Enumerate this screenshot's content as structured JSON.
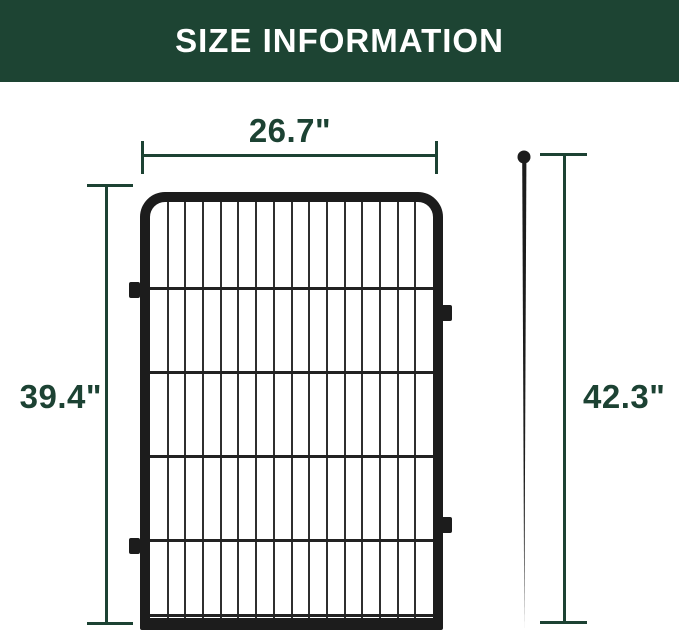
{
  "header": {
    "title": "SIZE INFORMATION"
  },
  "colors": {
    "background": "#ffffff",
    "header_bg": "#1d4433",
    "header_text": "#ffffff",
    "dimension_green": "#1c4233",
    "fence_black": "#1c1c1c",
    "wire_gray": "#2f2f2f"
  },
  "dimensions": {
    "panel_width": {
      "label": "26.7\""
    },
    "panel_height": {
      "label": "39.4\""
    },
    "stake_height": {
      "label": "42.3\""
    }
  },
  "fence": {
    "vertical_wire_count": 15,
    "horizontal_wire_offsets_px": [
      85,
      169,
      253,
      337,
      412
    ],
    "tabs": [
      {
        "side": "left",
        "top": 282
      },
      {
        "side": "left",
        "top": 538
      },
      {
        "side": "right",
        "top": 305
      },
      {
        "side": "right",
        "top": 517
      }
    ]
  }
}
